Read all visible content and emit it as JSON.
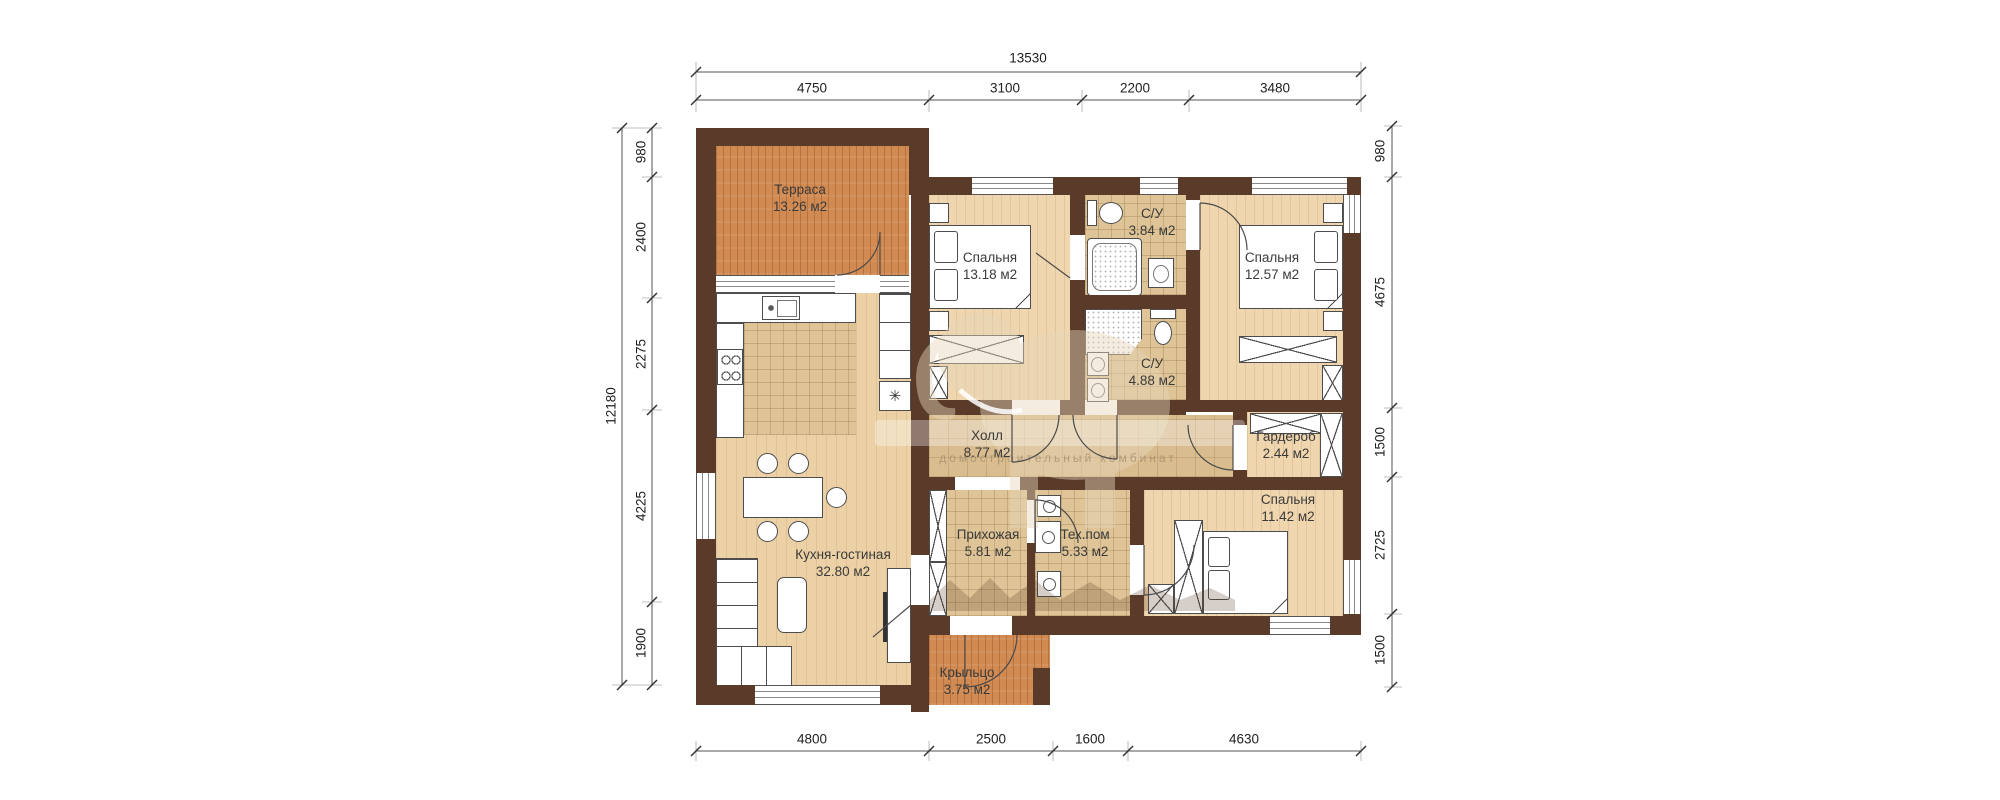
{
  "plan": {
    "dims": {
      "top": {
        "total": "13530",
        "segments": [
          "4750",
          "3100",
          "2200",
          "3480"
        ]
      },
      "bottom": {
        "segments": [
          "4800",
          "2500",
          "1600",
          "4630"
        ]
      },
      "left": {
        "total": "12180",
        "segments": [
          "980",
          "2400",
          "2275",
          "4225",
          "1900"
        ]
      },
      "right": {
        "segments": [
          "980",
          "4675",
          "1500",
          "2725",
          "1500"
        ]
      }
    },
    "rooms": {
      "terrace": {
        "name": "Терраса",
        "area": "13.26 м2"
      },
      "bedroom1": {
        "name": "Спальня",
        "area": "13.18 м2"
      },
      "bathroom1": {
        "name": "С/У",
        "area": "3.84 м2"
      },
      "bedroom2": {
        "name": "Спальня",
        "area": "12.57 м2"
      },
      "bathroom2": {
        "name": "С/У",
        "area": "4.88 м2"
      },
      "hall": {
        "name": "Холл",
        "area": "8.77 м2"
      },
      "wardrobe": {
        "name": "Гардероб",
        "area": "2.44 м2"
      },
      "bedroom3": {
        "name": "Спальня",
        "area": "11.42 м2"
      },
      "kitchen_living": {
        "name": "Кухня-гостиная",
        "area": "32.80 м2"
      },
      "entry": {
        "name": "Прихожая",
        "area": "5.81 м2"
      },
      "tech": {
        "name": "Тех.пом",
        "area": "5.33 м2"
      },
      "porch": {
        "name": "Крыльцо",
        "area": "3.75 м2"
      }
    },
    "icons": {
      "fridge_glyph": "✳"
    },
    "watermark": {
      "caption": "домостроительный комбинат"
    },
    "colors": {
      "wall": "#5a3a29",
      "wood_floor": "#f0d6af",
      "terrace_floor": "#d18a52",
      "tile_floor": "#dec496"
    }
  }
}
